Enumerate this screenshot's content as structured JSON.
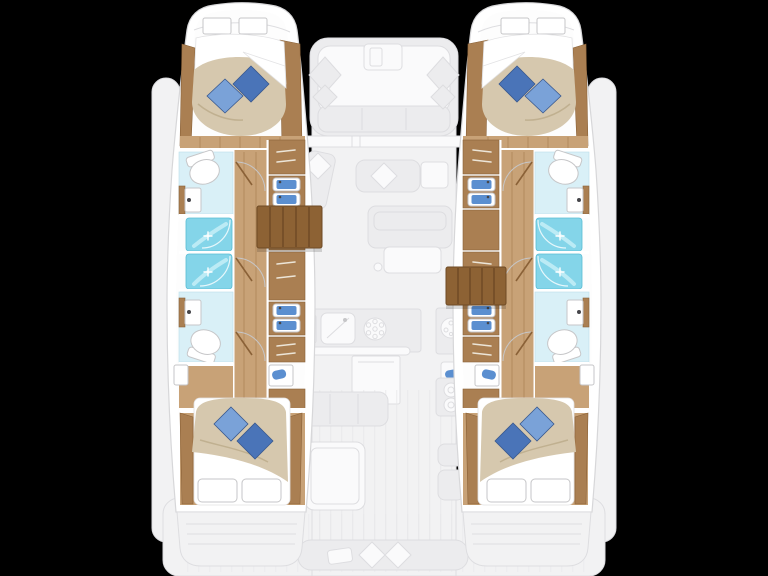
{
  "image": {
    "width": 768,
    "height": 576,
    "kind": "catamaran-yacht-floor-plan-top-view",
    "background": "#000000"
  },
  "colors": {
    "background": "#000000",
    "deck": "#f2f2f3",
    "deck_line": "#dddde0",
    "deck_item": "#ececee",
    "deck_white": "#fafafb",
    "deck_plank": "#e7e7e9",
    "hull_wall": "#ffffff",
    "hull_stroke": "#d7d7d9",
    "hull_floor": "#fdfdfd",
    "wood_floor": "#c8a277",
    "wood_floor_line": "#b2895c",
    "wood_panel": "#aa7f52",
    "wood_dark": "#8a6137",
    "steps": "#8d6234",
    "steps_dark": "#6e4a25",
    "duvet": "#d6c8ae",
    "duvet_shadow": "#c0b090",
    "linen": "#ffffff",
    "linen_stroke": "#e2e2e4",
    "pillow_dark": "#4a74b8",
    "pillow_light": "#7aa2d8",
    "pillow_edge": "#39598f",
    "shower": "#84d5e9",
    "shower_edge": "#58bcd4",
    "shower_streak": "#c6eef7",
    "bath_floor": "#d9f0f7",
    "bath_edge": "#b9dee9",
    "sink_basin": "#5b8fd0",
    "vanity_dark": "#46464a",
    "fixture": "#ffffff",
    "fixture_stroke": "#c6c6c8",
    "handle_light": "#ece5d8"
  },
  "inventory": {
    "hulls": [
      "port",
      "starboard"
    ],
    "cabins_total": 4,
    "double_beds": 4,
    "blue_decor_pillows": 8,
    "white_pillows": 8,
    "bathrooms_total": 4,
    "toilets": 4,
    "shower_stalls": 4,
    "wash_basins": 4,
    "companionway_stairs": 2,
    "foredeck_lounge": 1,
    "saloon_lounge": 1,
    "galley": 1,
    "nav_table": 1,
    "cockpit_table": 1,
    "stern_bench": 1
  },
  "style_notes": {
    "highlighted_areas": "hull cabins and bathrooms shown in full color",
    "faded_areas": "bridgedeck saloon, galley, foredeck and cockpit shown washed-out gray"
  }
}
